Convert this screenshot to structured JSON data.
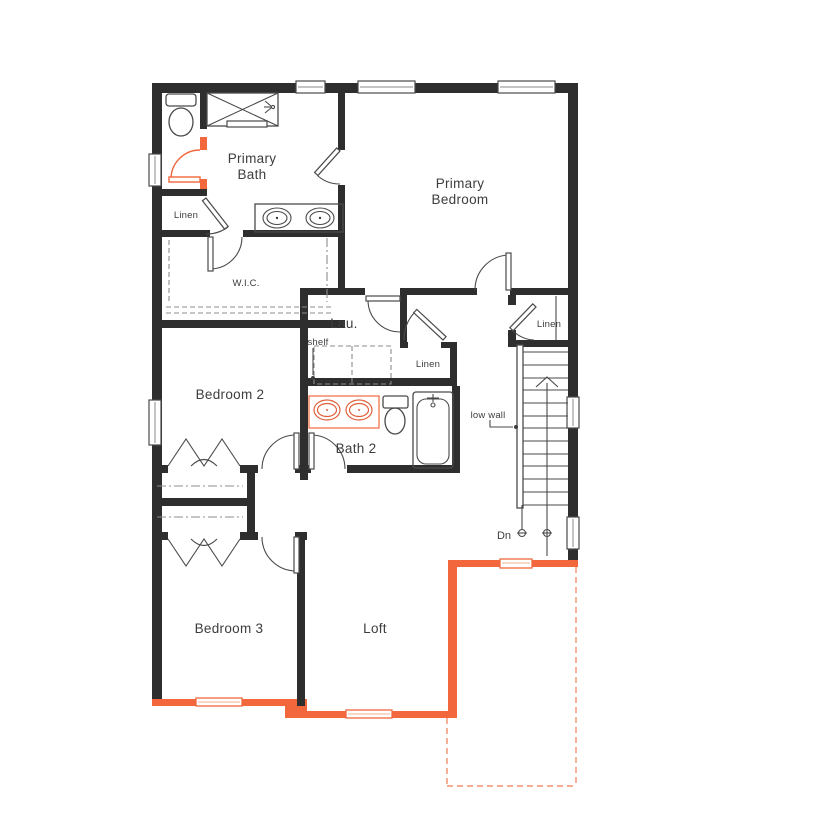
{
  "plan": {
    "labels": {
      "primary_bath_1": "Primary",
      "primary_bath_2": "Bath",
      "primary_bedroom_1": "Primary",
      "primary_bedroom_2": "Bedroom",
      "linen_bath": "Linen",
      "wic": "W.I.C.",
      "laundry": "Lau.",
      "shelf": "shelf",
      "linen_hall": "Linen",
      "linen_stairs": "Linen",
      "bedroom2": "Bedroom 2",
      "bath2": "Bath 2",
      "low_wall": "low wall",
      "dn": "Dn",
      "bedroom3": "Bedroom 3",
      "loft": "Loft"
    },
    "colors": {
      "wall": "#2e2e2e",
      "accent": "#f2683c",
      "line": "#4a4a4a",
      "dash": "#8c8c8c",
      "text": "#3d3d3d",
      "sink": "#e0603a"
    }
  }
}
